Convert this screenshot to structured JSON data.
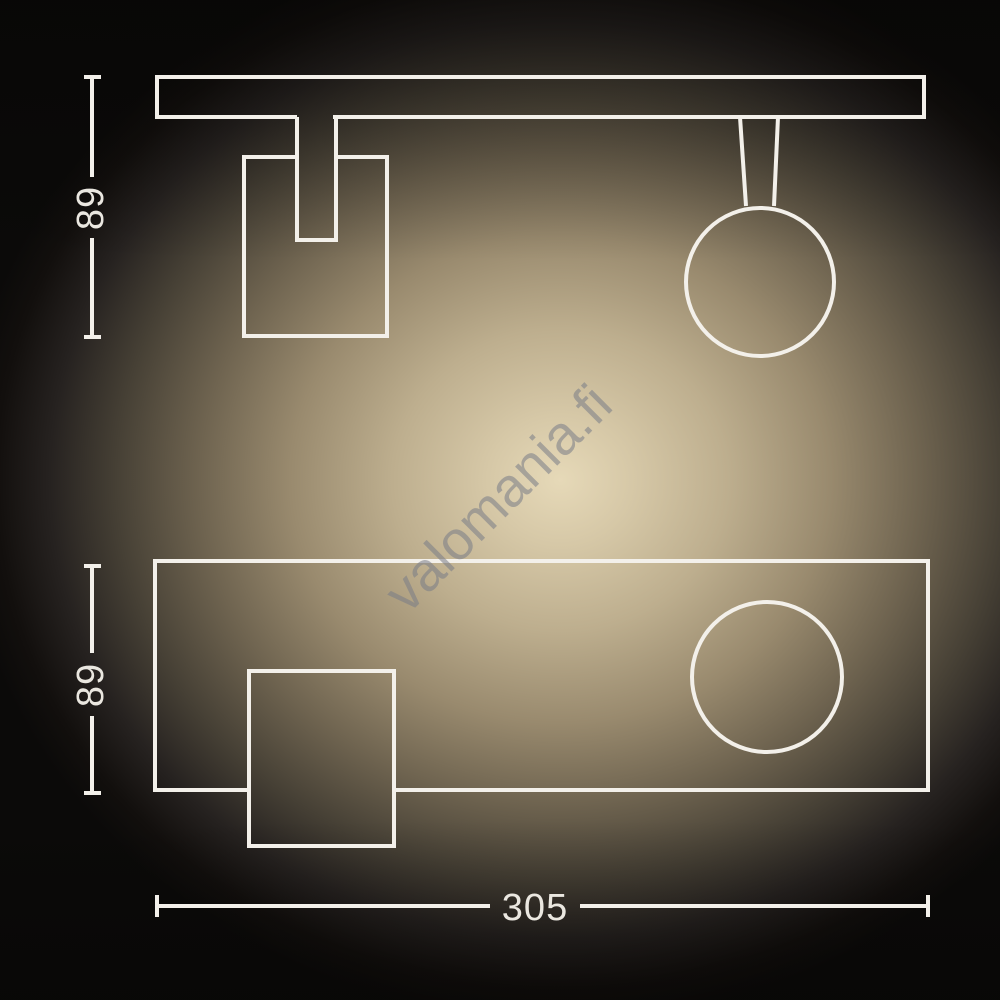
{
  "watermark": {
    "text": "valomania.fi"
  },
  "dimensions": {
    "top_view_height": "89",
    "front_view_height": "89",
    "front_view_width": "305"
  },
  "colors": {
    "line": "#f3f0ea",
    "dim_text": "#eae7e0",
    "watermark": "rgba(120,124,134,0.55)",
    "glow_center": "#e6d9b8",
    "bg_edge": "#0b0a09"
  }
}
